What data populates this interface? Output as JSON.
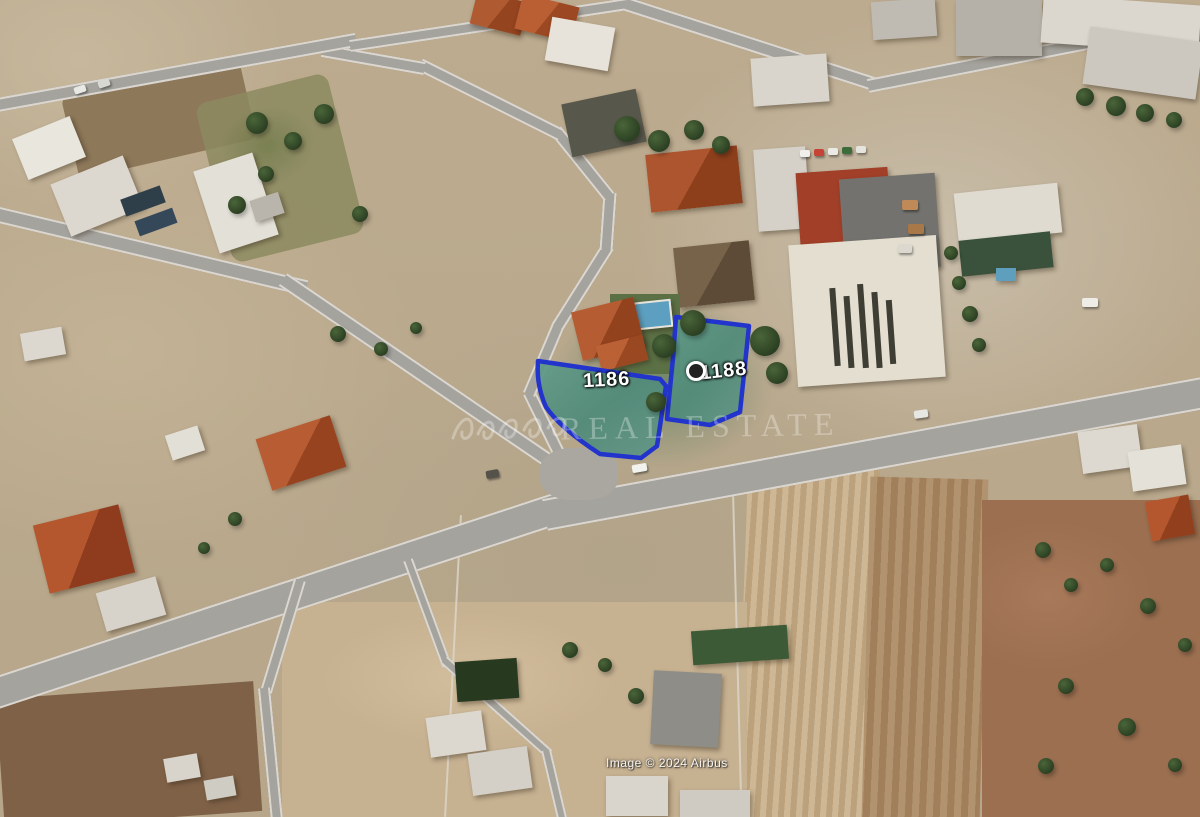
{
  "map": {
    "plot_labels": [
      {
        "id": "plot-1186",
        "label": "1186"
      },
      {
        "id": "plot-1188",
        "label": "1188"
      }
    ],
    "marker": "circle-marker",
    "watermark_text": "REAL ESTATE",
    "attribution": "Image © 2024 Airbus",
    "colors": {
      "plot_outline_blue": "#2234cc",
      "plot_fill_teal": "#54907f",
      "road_gray": "#a5a39d",
      "field_tan": "#bcab8f",
      "plowed_field_brown": "#ab8d68",
      "roof_red": "#a94f2b",
      "roof_white": "#e7e4dc",
      "tree_green": "#2f4526"
    }
  }
}
